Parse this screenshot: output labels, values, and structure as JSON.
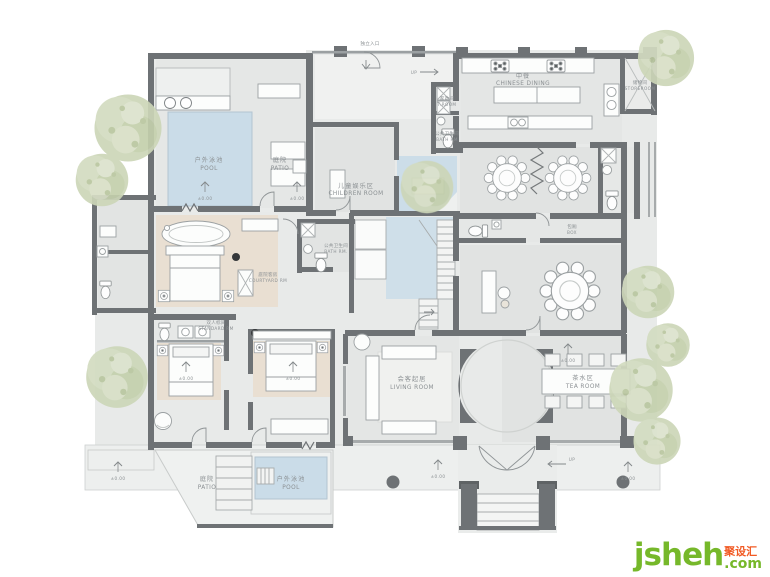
{
  "palette": {
    "wall": "#6e7275",
    "wall_light": "#a7abac",
    "floor": "#e8eae9",
    "pool": "#cadce8",
    "water": "#ccdde8",
    "stair_water": "#cfdfe9",
    "wood": "#e9dfd2",
    "tree": "#ccd6b8",
    "label": "#8b9093",
    "watermark_green": "#76b82a",
    "watermark_orange": "#f15a24"
  },
  "rooms": {
    "entrance": {
      "zh": "独立入口",
      "en": ""
    },
    "pool_top": {
      "zh": "户外泳池",
      "en": "POOL"
    },
    "patio_top": {
      "zh": "庭院",
      "en": "PATIO"
    },
    "children": {
      "zh": "儿童娱乐区",
      "en": "CHILDREN ROOM"
    },
    "dining": {
      "zh": "中餐",
      "en": "CHINESE DINING"
    },
    "storeroom": {
      "zh": "储物间",
      "en": "STOREROOM"
    },
    "laundry": {
      "zh": "家政间",
      "en": "T.ROOM"
    },
    "bath_kitchen": {
      "zh": "公共卫生间",
      "en": "BATH RM"
    },
    "bath_center": {
      "zh": "公共卫生间",
      "en": "BATH RM."
    },
    "courtyard_rm": {
      "zh": "庭院客房",
      "en": "COURTYARD RM"
    },
    "standard_rm": {
      "zh": "双人标间",
      "en": "STANDARD RM"
    },
    "box": {
      "zh": "包厢",
      "en": "BOX"
    },
    "living": {
      "zh": "会客起居",
      "en": "LIVING ROOM"
    },
    "tea": {
      "zh": "茶水区",
      "en": "TEA ROOM"
    },
    "patio_bottom": {
      "zh": "庭院",
      "en": "PATIO"
    },
    "pool_bottom": {
      "zh": "户外泳池",
      "en": "POOL"
    }
  },
  "markers": {
    "level": "±0.00",
    "up": "UP"
  },
  "watermark": {
    "brand": "jsheh",
    "cn": "聚设汇",
    "tld": ".com"
  }
}
